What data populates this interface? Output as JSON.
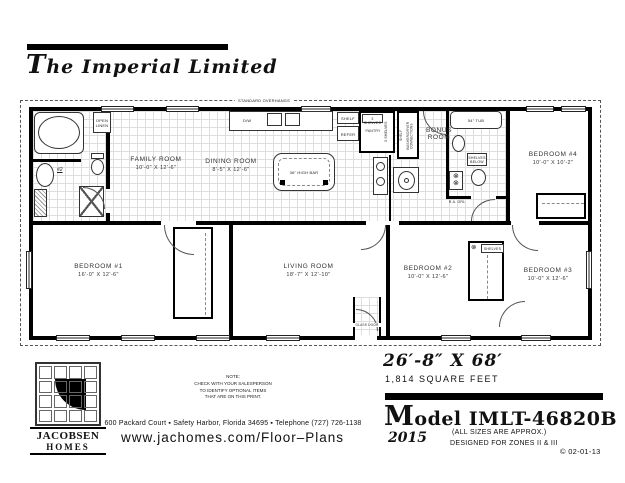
{
  "title": "The Imperial Limited",
  "plan": {
    "overhangs": "STANDARD OVERHANGS",
    "rooms": [
      {
        "name": "FAMILY ROOM",
        "dims": "10'-0\" X 12'-6\""
      },
      {
        "name": "DINING ROOM",
        "dims": "8'-5\" X 12'-6\""
      },
      {
        "name": "BONUS ROOM",
        "dims": ""
      },
      {
        "name": "BEDROOM #4",
        "dims": "10'-0\" X 10'-2\""
      },
      {
        "name": "BEDROOM #1",
        "dims": "16'-0\" X 12'-6\""
      },
      {
        "name": "LIVING ROOM",
        "dims": "18'-7\" X 12'-10\""
      },
      {
        "name": "BEDROOM #2",
        "dims": "10'-0\" X 12'-6\""
      },
      {
        "name": "BEDROOM #3",
        "dims": "10'-0\" X 12'-6\""
      }
    ],
    "labels": {
      "open_linen": "OPEN LINEN",
      "bath_number": "#2",
      "dw": "D/W",
      "shelf": "SHELF",
      "refer": "REFER",
      "three_shelves": "3 SHELVES",
      "pantry": "PANTRY",
      "washer_dryer": "WASHER/DRYER CONNECTIONS",
      "tub": "54\" TUB",
      "shelves_below": "SHELVES BELOW",
      "ra_grille": "R.A. GRL",
      "high_bar": "36\" HIGH BAR",
      "glass_door": "GLASS DOOR",
      "shelves": "SHELVES",
      "grille_symbol": "⊗"
    }
  },
  "footer": {
    "logo_top": "JACOBSEN",
    "logo_bottom": "HOMES",
    "note_lines": [
      "NOTE:",
      "CHECK WITH YOUR SALESPERSON",
      "TO IDENTIFY OPTIONAL ITEMS",
      "THAT ARE ON THIS PRINT."
    ],
    "address": "600 Packard Court ▪ Safety Harbor, Florida 34695 ▪ Telephone (727) 726-1138",
    "url": "www.jachomes.com/Floor–Plans"
  },
  "specs": {
    "size": "26′-8″ X 68′",
    "sqft": "1,814 SQUARE FEET",
    "model": "Model IMLT-46820B",
    "year": "2015",
    "approx": "(ALL SIZES ARE APPROX.)",
    "zones": "DESIGNED FOR ZONES II & III",
    "copyright": "© 02-01-13"
  }
}
